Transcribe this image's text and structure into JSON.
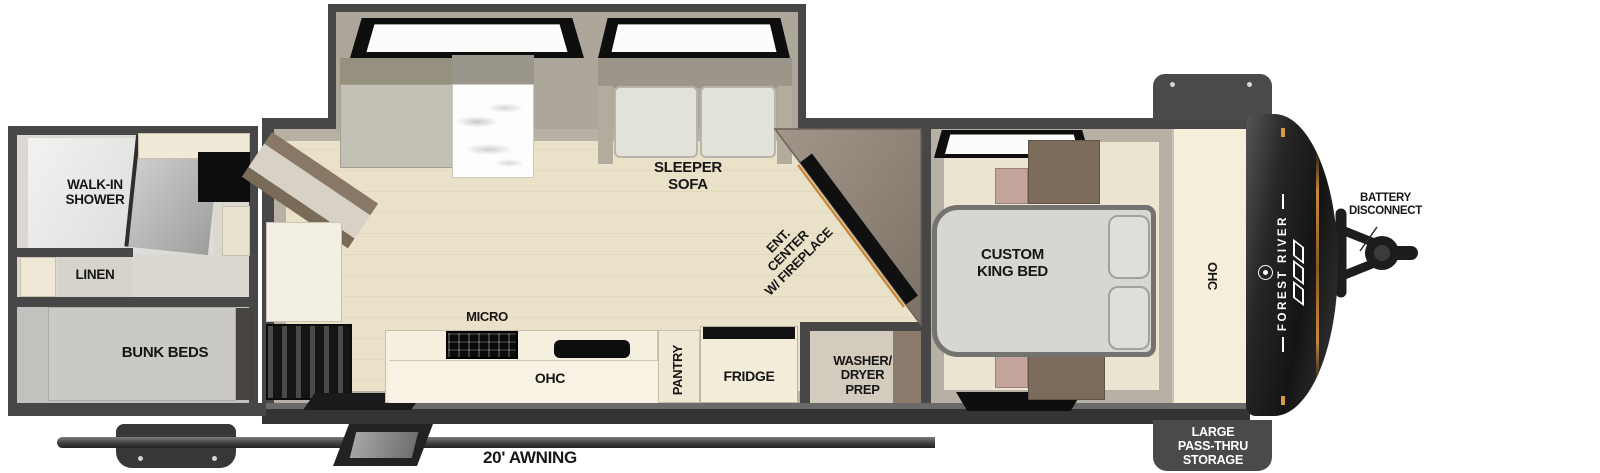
{
  "title": "Travel trailer floor plan - rear bath bunkhouse with front king bed",
  "colors": {
    "wall": "#474747",
    "wall_band": "#b6b1a4",
    "floor_wood": "#e9e0c8",
    "floor_bedroom": "#ebe4d1",
    "cabinet_cream": "#f4eedd",
    "front_cap": "#1c1c1c",
    "accent_amber": "#c9893c",
    "label_text": "#161616",
    "storage_box": "#4a4a4a"
  },
  "labels": {
    "walk_in_shower": {
      "line1": "WALK-IN",
      "line2": "SHOWER"
    },
    "linen": {
      "text": "LINEN"
    },
    "bunk_beds": {
      "text": "BUNK BEDS"
    },
    "sleeper_sofa": {
      "line1": "SLEEPER",
      "line2": "SOFA"
    },
    "ent_center": {
      "line1": "ENT.",
      "line2": "CENTER",
      "line3": "W/ FIREPLACE"
    },
    "micro": {
      "text": "MICRO"
    },
    "ohc_kitchen": {
      "text": "OHC"
    },
    "pantry": {
      "text": "PANTRY"
    },
    "fridge": {
      "text": "FRIDGE"
    },
    "washer_dryer": {
      "line1": "WASHER/",
      "line2": "DRYER",
      "line3": "PREP"
    },
    "custom_king_bed": {
      "line1": "CUSTOM",
      "line2": "KING BED"
    },
    "ohc_bedroom": {
      "text": "OHC"
    },
    "battery_disconnect": {
      "line1": "BATTERY",
      "line2": "DISCONNECT"
    },
    "pass_thru_storage": {
      "line1": "LARGE",
      "line2": "PASS-THRU",
      "line3": "STORAGE"
    },
    "awning": {
      "text": "20' AWNING"
    },
    "brand": {
      "text": "FOREST RIVER"
    }
  }
}
